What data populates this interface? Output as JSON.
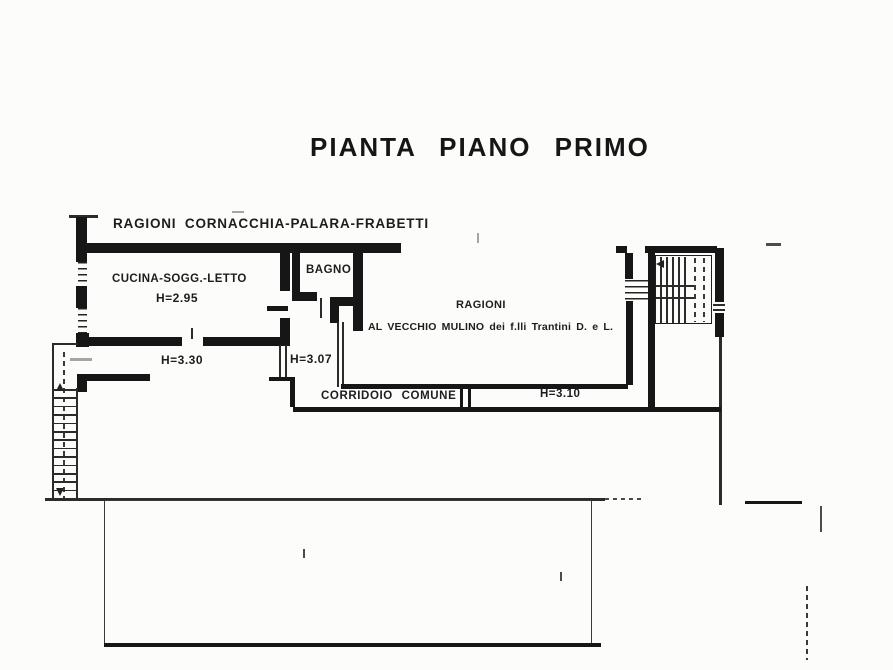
{
  "title": "PIANTA PIANO PRIMO",
  "labels": {
    "owners_top": "RAGIONI CORNACCHIA-PALARA-FRABETTI",
    "room_cucina": "CUCINA-SOGG.-LETTO",
    "room_cucina_height": "H=2.95",
    "room_bagno": "BAGNO",
    "owners_right_line1": "RAGIONI",
    "owners_right_line2": "AL VECCHIO MULINO dei f.lli Trantini D. e L.",
    "height_left_room": "H=3.30",
    "height_mid_room": "H=3.07",
    "corridor": "CORRIDOIO COMUNE",
    "corridor_height": "H=3.10"
  },
  "colors": {
    "ink": "#161616",
    "paper": "#fcfcfb"
  }
}
